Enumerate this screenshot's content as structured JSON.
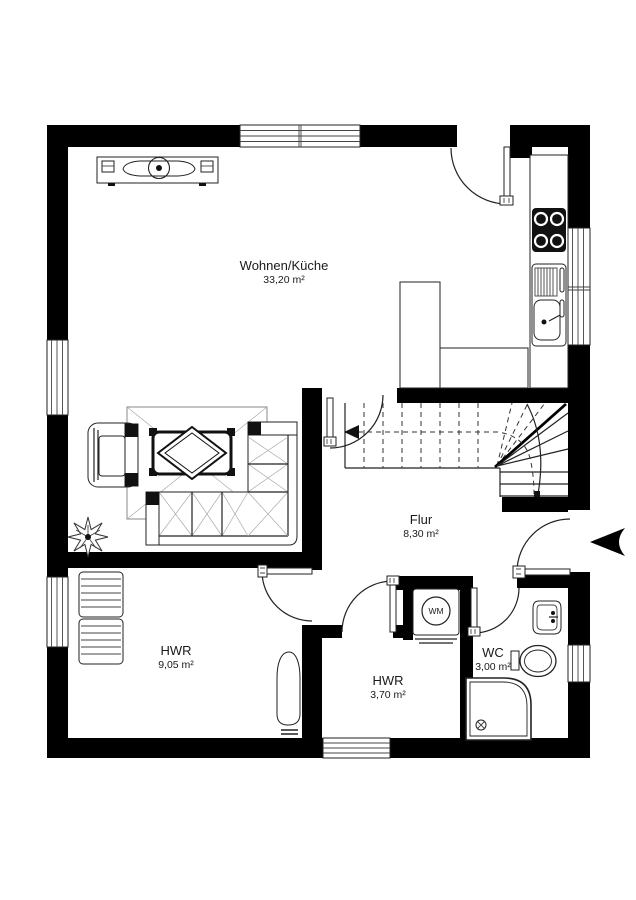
{
  "plan": {
    "rooms": [
      {
        "name": "Wohnen/Küche",
        "area": "33,20 m²"
      },
      {
        "name": "Flur",
        "area": "8,30 m²"
      },
      {
        "name": "HWR",
        "area": "9,05 m²"
      },
      {
        "name": "HWR",
        "area": "3,70 m²"
      },
      {
        "name": "WC",
        "area": "3,00 m²"
      }
    ],
    "appliances": {
      "washing_machine_label": "WM"
    },
    "colors": {
      "wall": "#000000",
      "background": "#ffffff",
      "line": "#222222"
    }
  }
}
